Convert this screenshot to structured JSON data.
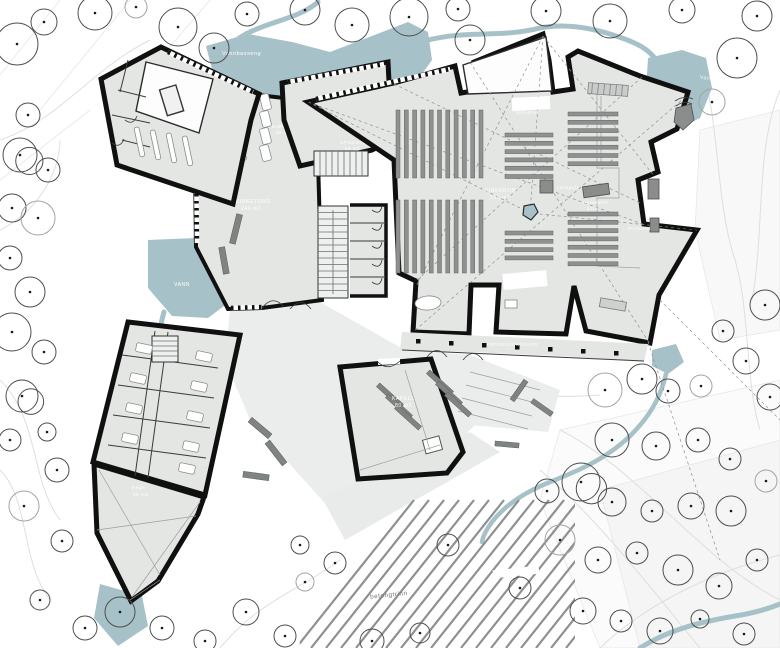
{
  "title": "Kloster og kirke – plan 1. etasje",
  "colors": {
    "water": "#a7c1c8",
    "floor": "#e4e6e3",
    "plaza": "#ebedec",
    "wall": "#101010",
    "pew": "#8e918f",
    "bench": "#7f8382",
    "tree_stroke": "#4d4f4e",
    "contour": "#dde0de",
    "label_light": "#ffffff",
    "label_dark": "#70736f"
  },
  "labels": {
    "vannbasseng": "Vannbasseng",
    "vann_left": "VANN",
    "vann_right": "Vann",
    "klosterrom1": "KLOSTERROM",
    "klosterrom2": "34 m2",
    "sidealter_top": "Sidealter",
    "sidealter_bottom": "Sidealter",
    "kirkerom1": "KIRKEROM",
    "kirkerom2": "550 m2",
    "lesepult": "Lesepult",
    "hovedalter1": "Hovedalter",
    "hovedalter2": "bord",
    "alter": "Alter",
    "prekestol": "Prekestol",
    "kirketorg1": "KIRKETORG",
    "kirketorg2": "240 m2",
    "kjokken1": "KJØKKEN",
    "kjokken2": "30 m2",
    "spisesal1": "SPISESAL",
    "spisesal2": "56 m2",
    "prosesjonsgang": "PROSESJONSGANG",
    "kapell1": "KAPELL",
    "kapell2": "80 m2",
    "hage1": "Hage",
    "hage2": "36 m2",
    "betongtrinn": "betongtrinn"
  },
  "trees": [
    {
      "x": 17,
      "y": 44,
      "r": 21
    },
    {
      "x": 44,
      "y": 22,
      "r": 13
    },
    {
      "x": 95,
      "y": 13,
      "r": 17
    },
    {
      "x": 136,
      "y": 7,
      "r": 11,
      "l": 1
    },
    {
      "x": 178,
      "y": 27,
      "r": 19
    },
    {
      "x": 214,
      "y": 48,
      "r": 15
    },
    {
      "x": 247,
      "y": 14,
      "r": 12
    },
    {
      "x": 305,
      "y": 10,
      "r": 15
    },
    {
      "x": 352,
      "y": 25,
      "r": 17
    },
    {
      "x": 409,
      "y": 17,
      "r": 19
    },
    {
      "x": 458,
      "y": 9,
      "r": 12
    },
    {
      "x": 470,
      "y": 40,
      "r": 15
    },
    {
      "x": 546,
      "y": 11,
      "r": 15
    },
    {
      "x": 610,
      "y": 21,
      "r": 17
    },
    {
      "x": 682,
      "y": 10,
      "r": 13
    },
    {
      "x": 757,
      "y": 16,
      "r": 15
    },
    {
      "x": 737,
      "y": 58,
      "r": 20
    },
    {
      "x": 712,
      "y": 102,
      "r": 13,
      "l": 1
    },
    {
      "x": 28,
      "y": 115,
      "r": 12
    },
    {
      "x": 20,
      "y": 155,
      "r": 17,
      "d": 1
    },
    {
      "x": 48,
      "y": 170,
      "r": 12
    },
    {
      "x": 12,
      "y": 208,
      "r": 14
    },
    {
      "x": 38,
      "y": 218,
      "r": 17,
      "l": 1
    },
    {
      "x": 10,
      "y": 258,
      "r": 12
    },
    {
      "x": 30,
      "y": 292,
      "r": 15
    },
    {
      "x": 12,
      "y": 332,
      "r": 19
    },
    {
      "x": 44,
      "y": 352,
      "r": 12
    },
    {
      "x": 22,
      "y": 396,
      "r": 16,
      "d": 1
    },
    {
      "x": 10,
      "y": 440,
      "r": 11
    },
    {
      "x": 47,
      "y": 432,
      "r": 9
    },
    {
      "x": 57,
      "y": 470,
      "r": 12
    },
    {
      "x": 24,
      "y": 506,
      "r": 15,
      "l": 1
    },
    {
      "x": 62,
      "y": 541,
      "r": 11
    },
    {
      "x": 40,
      "y": 600,
      "r": 10
    },
    {
      "x": 85,
      "y": 628,
      "r": 12
    },
    {
      "x": 120,
      "y": 612,
      "r": 15
    },
    {
      "x": 162,
      "y": 628,
      "r": 12
    },
    {
      "x": 205,
      "y": 641,
      "r": 11
    },
    {
      "x": 246,
      "y": 612,
      "r": 13
    },
    {
      "x": 285,
      "y": 636,
      "r": 11
    },
    {
      "x": 305,
      "y": 582,
      "r": 9,
      "l": 1
    },
    {
      "x": 335,
      "y": 563,
      "r": 11
    },
    {
      "x": 372,
      "y": 641,
      "r": 12
    },
    {
      "x": 420,
      "y": 633,
      "r": 10
    },
    {
      "x": 448,
      "y": 545,
      "r": 11
    },
    {
      "x": 300,
      "y": 545,
      "r": 9
    },
    {
      "x": 520,
      "y": 588,
      "r": 11
    },
    {
      "x": 560,
      "y": 540,
      "r": 15,
      "l": 1
    },
    {
      "x": 598,
      "y": 560,
      "r": 13
    },
    {
      "x": 637,
      "y": 553,
      "r": 11
    },
    {
      "x": 678,
      "y": 570,
      "r": 15
    },
    {
      "x": 719,
      "y": 586,
      "r": 13
    },
    {
      "x": 757,
      "y": 560,
      "r": 11
    },
    {
      "x": 583,
      "y": 611,
      "r": 13
    },
    {
      "x": 621,
      "y": 621,
      "r": 11
    },
    {
      "x": 660,
      "y": 631,
      "r": 13
    },
    {
      "x": 700,
      "y": 619,
      "r": 9
    },
    {
      "x": 744,
      "y": 634,
      "r": 11
    },
    {
      "x": 605,
      "y": 390,
      "r": 17,
      "l": 1
    },
    {
      "x": 642,
      "y": 379,
      "r": 15
    },
    {
      "x": 668,
      "y": 391,
      "r": 12
    },
    {
      "x": 612,
      "y": 440,
      "r": 17
    },
    {
      "x": 656,
      "y": 446,
      "r": 14
    },
    {
      "x": 698,
      "y": 440,
      "r": 12
    },
    {
      "x": 730,
      "y": 459,
      "r": 11
    },
    {
      "x": 581,
      "y": 482,
      "r": 19,
      "d": 1
    },
    {
      "x": 547,
      "y": 491,
      "r": 12
    },
    {
      "x": 612,
      "y": 502,
      "r": 14
    },
    {
      "x": 652,
      "y": 511,
      "r": 11
    },
    {
      "x": 691,
      "y": 506,
      "r": 13
    },
    {
      "x": 731,
      "y": 511,
      "r": 15
    },
    {
      "x": 766,
      "y": 481,
      "r": 11,
      "l": 1
    },
    {
      "x": 765,
      "y": 305,
      "r": 15
    },
    {
      "x": 723,
      "y": 331,
      "r": 11
    },
    {
      "x": 746,
      "y": 361,
      "r": 13
    },
    {
      "x": 701,
      "y": 386,
      "r": 11,
      "l": 1
    },
    {
      "x": 770,
      "y": 397,
      "r": 13
    }
  ],
  "pew_blocks": [
    {
      "x": 396,
      "y": 110,
      "orient": "v",
      "count": 11,
      "step": 8.3,
      "len": 68
    },
    {
      "x": 396,
      "y": 200,
      "orient": "v",
      "count": 11,
      "step": 8.3,
      "len": 73
    },
    {
      "x": 505,
      "y": 133,
      "orient": "h",
      "count": 6,
      "step": 8.3,
      "len": 48
    },
    {
      "x": 568,
      "y": 112,
      "orient": "h",
      "count": 7,
      "step": 8.3,
      "len": 50
    },
    {
      "x": 505,
      "y": 231,
      "orient": "h",
      "count": 4,
      "step": 8.3,
      "len": 48
    },
    {
      "x": 568,
      "y": 212,
      "orient": "h",
      "count": 7,
      "step": 8.3,
      "len": 50
    }
  ],
  "tables": [
    {
      "x": 236,
      "y": 94,
      "rot": -14
    },
    {
      "x": 261,
      "y": 94,
      "rot": -14
    },
    {
      "x": 236,
      "y": 111,
      "rot": -14
    },
    {
      "x": 261,
      "y": 111,
      "rot": -14
    },
    {
      "x": 236,
      "y": 128,
      "rot": -14
    },
    {
      "x": 261,
      "y": 128,
      "rot": -14
    },
    {
      "x": 236,
      "y": 145,
      "rot": -14
    },
    {
      "x": 261,
      "y": 145,
      "rot": -14
    },
    {
      "x": 310,
      "y": 92,
      "rot": -6
    },
    {
      "x": 334,
      "y": 92,
      "rot": -6
    },
    {
      "x": 358,
      "y": 92,
      "rot": -6
    },
    {
      "x": 310,
      "y": 109,
      "rot": -6
    },
    {
      "x": 334,
      "y": 109,
      "rot": -6
    },
    {
      "x": 358,
      "y": 109,
      "rot": -6
    },
    {
      "x": 310,
      "y": 126,
      "rot": -6
    },
    {
      "x": 334,
      "y": 126,
      "rot": -6
    },
    {
      "x": 358,
      "y": 126,
      "rot": -6
    },
    {
      "x": 310,
      "y": 143,
      "rot": -6
    },
    {
      "x": 334,
      "y": 143,
      "rot": -6
    },
    {
      "x": 358,
      "y": 143,
      "rot": -6
    }
  ],
  "beds": [
    {
      "x": 136,
      "y": 344
    },
    {
      "x": 196,
      "y": 352
    },
    {
      "x": 130,
      "y": 374
    },
    {
      "x": 191,
      "y": 382
    },
    {
      "x": 126,
      "y": 404
    },
    {
      "x": 187,
      "y": 412
    },
    {
      "x": 122,
      "y": 434
    },
    {
      "x": 183,
      "y": 442
    },
    {
      "x": 179,
      "y": 464
    }
  ],
  "benches_dark": [
    {
      "x": 233,
      "y": 214,
      "w": 6,
      "h": 30,
      "rot": 14
    },
    {
      "x": 221,
      "y": 247,
      "w": 6,
      "h": 27,
      "rot": -10
    },
    {
      "x": 247,
      "y": 425,
      "w": 26,
      "h": 6,
      "rot": 40
    },
    {
      "x": 262,
      "y": 450,
      "w": 28,
      "h": 6,
      "rot": 52
    },
    {
      "x": 243,
      "y": 473,
      "w": 26,
      "h": 6,
      "rot": 8
    },
    {
      "x": 507,
      "y": 388,
      "w": 24,
      "h": 5,
      "rot": -55
    },
    {
      "x": 530,
      "y": 405,
      "w": 24,
      "h": 5,
      "rot": 35
    },
    {
      "x": 495,
      "y": 442,
      "w": 24,
      "h": 5,
      "rot": 5
    }
  ],
  "chapel_benches": [
    {
      "x": 374,
      "y": 393
    },
    {
      "x": 383,
      "y": 404
    },
    {
      "x": 392,
      "y": 415
    },
    {
      "x": 424,
      "y": 380
    },
    {
      "x": 433,
      "y": 391
    },
    {
      "x": 442,
      "y": 402
    }
  ],
  "columns": [
    {
      "x": 416,
      "y": 339
    },
    {
      "x": 449,
      "y": 341
    },
    {
      "x": 482,
      "y": 343
    },
    {
      "x": 515,
      "y": 345
    },
    {
      "x": 548,
      "y": 347
    },
    {
      "x": 581,
      "y": 349
    },
    {
      "x": 614,
      "y": 351
    }
  ]
}
